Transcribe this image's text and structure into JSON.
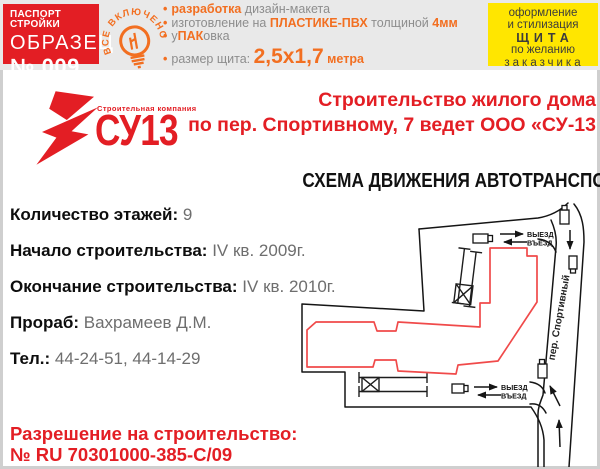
{
  "header": {
    "passport_box": {
      "line1": "ПАСПОРТ СТРОЙКИ",
      "line2": "ОБРАЗЕЦ",
      "line3": "№ 009"
    },
    "stamp": {
      "text": "ВСЕ ВКЛЮЧЕНО"
    },
    "bullets": {
      "b1": {
        "s1": "разработка",
        "s2": " дизайн-макета"
      },
      "b2": {
        "s1": "изготовление на ",
        "s2": "ПЛАСТИКЕ-ПВХ",
        "s3": " толщиной ",
        "s4": "4мм"
      },
      "b3": {
        "s1": "у",
        "s2": "ПАК",
        "s3": "овка"
      },
      "b4": {
        "s1": "размер щита: ",
        "s2": "2,5х1,7",
        "s3": " метра"
      }
    },
    "offer_box": {
      "l1": "оформление",
      "l2": "и стилизация",
      "l3": "ЩИТА",
      "l4": "по желанию",
      "l5": "заказчика"
    }
  },
  "logo": {
    "company_type": "Строительная компания",
    "name": "СУ13"
  },
  "heading": {
    "line1": "Строительство жилого дома",
    "line2": "по пер. Спортивному, 7 ведет ООО «СУ-13"
  },
  "info": {
    "rows": [
      {
        "label": "Количество этажей:",
        "value": "9"
      },
      {
        "label": "Начало строительства:",
        "value": "IV кв. 2009г."
      },
      {
        "label": "Окончание строительства:",
        "value": "IV кв. 2010г."
      },
      {
        "label": "Прораб:",
        "value": "Вахрамеев Д.М."
      },
      {
        "label": "Тел.:",
        "value": "44-24-51, 44-14-29"
      }
    ]
  },
  "permit": {
    "line1": "Разрешение на строительство:",
    "line2": "№ RU 70301000-385-С/09"
  },
  "map": {
    "title": "СХЕМА ДВИЖЕНИЯ АВТОТРАНСПОРТА",
    "street_label": "пер. Спортивный",
    "top_exit": "ВЫЕЗД",
    "top_entry": "ВЪЕЗД",
    "bottom_exit": "ВЫЕЗД",
    "bottom_entry": "ВЪЕЗД"
  },
  "colors": {
    "accent_red": "#e31e24",
    "accent_orange": "#f26f21",
    "offer_yellow": "#ffe600",
    "building_outline": "#f04a4a"
  }
}
